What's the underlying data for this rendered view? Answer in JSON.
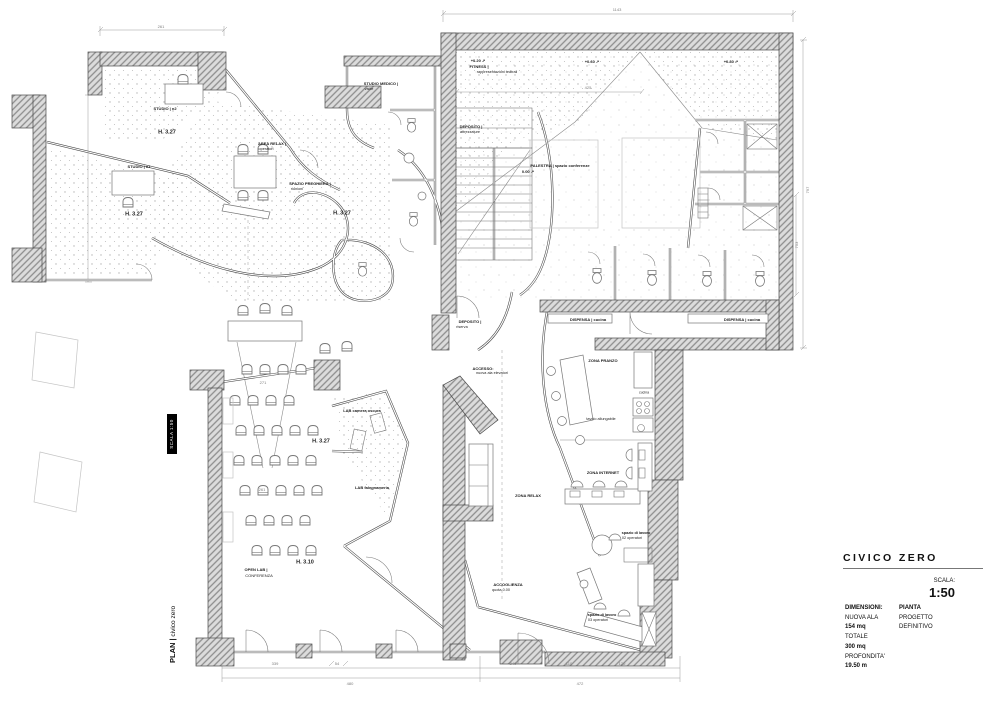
{
  "colors": {
    "paper": "#ffffff",
    "ink": "#1c1c1c",
    "wall_gray": "#8d8d8d",
    "dim_gray": "#9a9a9a"
  },
  "title_block": {
    "project": "CIVICO ZERO",
    "scala_label": "SCALA:",
    "scala_value": "1:50",
    "col_left": {
      "header": "DIMENSIONI:",
      "rows": [
        {
          "t": "NUOVA ALA",
          "b": false
        },
        {
          "t": "154 mq",
          "b": true
        },
        {
          "t": "TOTALE",
          "b": false
        },
        {
          "t": "300 mq",
          "b": true
        },
        {
          "t": "PROFONDITA'",
          "b": false
        },
        {
          "t": "19.50 m",
          "b": true
        }
      ]
    },
    "col_right": {
      "header": "PIANTA",
      "rows": [
        {
          "t": "PROGETTO",
          "b": false
        },
        {
          "t": "DEFINITIVO",
          "b": false
        }
      ]
    }
  },
  "side_annotations": {
    "plan_bold": "PLAN |",
    "plan_text": " civico zero",
    "scale_tag": "SCALA 1:50"
  },
  "plan": {
    "labels": [
      {
        "t": "STUDIO | n2",
        "x": 165,
        "y": 109,
        "s": 4,
        "b": 1
      },
      {
        "t": "H. 3.27",
        "x": 167,
        "y": 133,
        "s": 5.5,
        "b": 1
      },
      {
        "t": "STUDIO | n1",
        "x": 139,
        "y": 167,
        "s": 4,
        "b": 1
      },
      {
        "t": "H. 3.27",
        "x": 134,
        "y": 215,
        "s": 5.5,
        "b": 1
      },
      {
        "t": "AREA RELAX |",
        "x": 272,
        "y": 144,
        "s": 4,
        "b": 1
      },
      {
        "t": "operatori",
        "x": 266,
        "y": 150,
        "s": 3.8
      },
      {
        "t": "SPAZIO PREGHIERA |",
        "x": 310,
        "y": 184,
        "s": 4,
        "b": 1
      },
      {
        "t": "riunioni",
        "x": 297,
        "y": 190,
        "s": 3.8
      },
      {
        "t": "H. 3.27",
        "x": 342,
        "y": 214,
        "s": 5.5,
        "b": 1
      },
      {
        "t": "STUDIO MEDICO |",
        "x": 381,
        "y": 84,
        "s": 4,
        "b": 1
      },
      {
        "t": "visite",
        "x": 369,
        "y": 90,
        "s": 3.8
      },
      {
        "t": "+0.20 ↗",
        "x": 478,
        "y": 61,
        "s": 4,
        "b": 1
      },
      {
        "t": "FITNESS |",
        "x": 479,
        "y": 67,
        "s": 4,
        "b": 1
      },
      {
        "t": "rappresentazioni teatrali",
        "x": 497,
        "y": 73,
        "s": 3.8
      },
      {
        "t": "+0.60 ↗",
        "x": 592,
        "y": 62,
        "s": 4,
        "b": 1
      },
      {
        "t": "+0.80 ↗",
        "x": 731,
        "y": 62,
        "s": 4,
        "b": 1
      },
      {
        "t": "DEPOSITO |",
        "x": 471,
        "y": 127,
        "s": 4,
        "b": 1
      },
      {
        "t": "attrezzature",
        "x": 470,
        "y": 133,
        "s": 3.8
      },
      {
        "t": "PALESTRA | spazio conferenze",
        "x": 560,
        "y": 166,
        "s": 4,
        "b": 1
      },
      {
        "t": "0.00 ↗",
        "x": 528,
        "y": 172,
        "s": 4,
        "b": 1
      },
      {
        "t": "DEPOSITO |",
        "x": 470,
        "y": 322,
        "s": 4,
        "b": 1
      },
      {
        "t": "riserva",
        "x": 462,
        "y": 328,
        "s": 3.8
      },
      {
        "t": "ACCESSO:",
        "x": 483,
        "y": 369,
        "s": 4,
        "b": 1
      },
      {
        "t": "nuova ala elevatori",
        "x": 492,
        "y": 374,
        "s": 3.8
      },
      {
        "t": "DISPENSA | cucina",
        "x": 588,
        "y": 320,
        "s": 4,
        "b": 1
      },
      {
        "t": "DISPENSA | cucina",
        "x": 742,
        "y": 320,
        "s": 4,
        "b": 1
      },
      {
        "t": "ZONA PRANZO",
        "x": 603,
        "y": 361,
        "s": 4,
        "b": 1
      },
      {
        "t": "cucina",
        "x": 644,
        "y": 393,
        "s": 3.5
      },
      {
        "t": "tavolo allungabile",
        "x": 601,
        "y": 420,
        "s": 3.8
      },
      {
        "t": "ZONA INTERNET",
        "x": 603,
        "y": 473,
        "s": 4,
        "b": 1
      },
      {
        "t": "ZONA RELAX",
        "x": 528,
        "y": 496,
        "s": 4,
        "b": 1
      },
      {
        "t": "LAB camera oscura",
        "x": 362,
        "y": 411,
        "s": 4,
        "b": 1
      },
      {
        "t": "LAB falegnameria",
        "x": 372,
        "y": 488,
        "s": 4,
        "b": 1
      },
      {
        "t": "H. 3.27",
        "x": 321,
        "y": 442,
        "s": 5.5,
        "b": 1
      },
      {
        "t": "OPEN LAB |",
        "x": 256,
        "y": 570,
        "s": 4,
        "b": 1
      },
      {
        "t": "CONFERENZA",
        "x": 259,
        "y": 576,
        "s": 4
      },
      {
        "t": "H. 3.10",
        "x": 305,
        "y": 563,
        "s": 5.5,
        "b": 1
      },
      {
        "t": "ACCOGLIENZA",
        "x": 508,
        "y": 585,
        "s": 4,
        "b": 1
      },
      {
        "t": "quota 0.00",
        "x": 501,
        "y": 591,
        "s": 3.8
      },
      {
        "t": "spazio di lavoro",
        "x": 602,
        "y": 616,
        "s": 3.8,
        "b": 1
      },
      {
        "t": "03 operatori",
        "x": 598,
        "y": 621,
        "s": 3.8
      },
      {
        "t": "spazio di lavoro",
        "x": 636,
        "y": 534,
        "s": 3.8,
        "b": 1
      },
      {
        "t": "02 operatori",
        "x": 632,
        "y": 539,
        "s": 3.8
      }
    ],
    "dims": [
      {
        "t": "1143",
        "x": 617,
        "y": 10
      },
      {
        "t": "261",
        "x": 161,
        "y": 27
      },
      {
        "t": "425",
        "x": 588,
        "y": 88
      },
      {
        "t": "797",
        "x": 808,
        "y": 190,
        "r": 1
      },
      {
        "t": "753",
        "x": 797,
        "y": 245,
        "r": 1
      },
      {
        "t": "271",
        "x": 263,
        "y": 383
      },
      {
        "t": "261",
        "x": 262,
        "y": 490
      },
      {
        "t": "339",
        "x": 275,
        "y": 664
      },
      {
        "t": "54",
        "x": 337,
        "y": 664
      },
      {
        "t": "480",
        "x": 350,
        "y": 684
      },
      {
        "t": "240",
        "x": 513,
        "y": 664
      },
      {
        "t": "110",
        "x": 569,
        "y": 664
      },
      {
        "t": "120",
        "x": 622,
        "y": 664
      },
      {
        "t": "472",
        "x": 580,
        "y": 684
      }
    ]
  }
}
